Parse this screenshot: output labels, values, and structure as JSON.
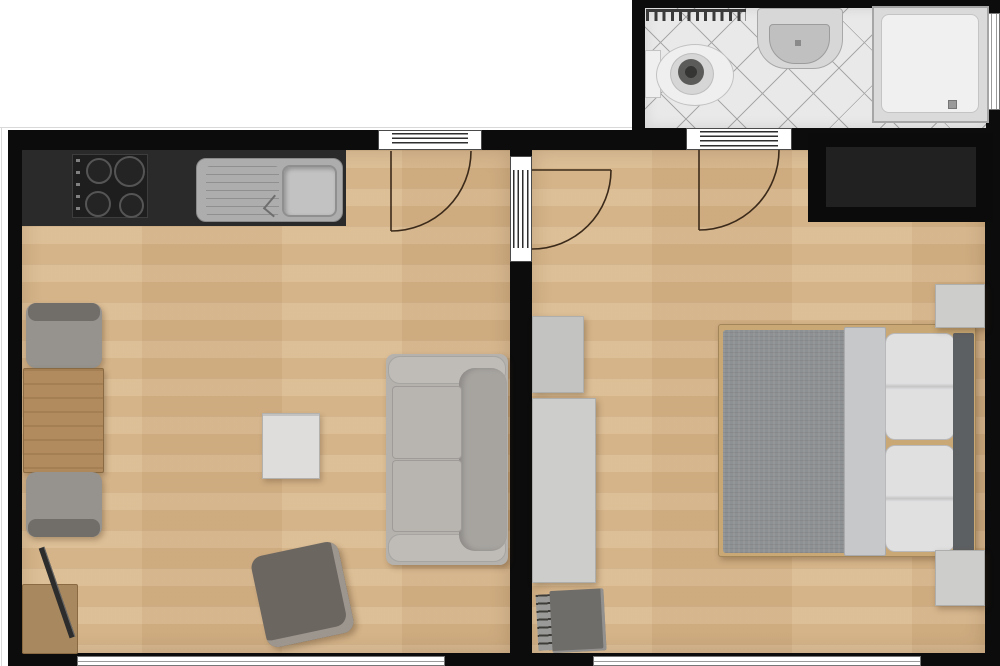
{
  "page": {
    "type": "apartment-floor-plan",
    "no_visible_text": true
  },
  "colors": {
    "bg": "#ffffff",
    "wall": "#0c0c0c",
    "floor-wood": "#d9b88c",
    "tile": "#e9e9e9",
    "tile-line": "#a8a8a8",
    "counter": "#2a2a2a",
    "appliance": "#1e1e1e",
    "steel": "#adadad",
    "steel-dark": "#8f8f8f",
    "porcelain": "#efefef",
    "porcelain-border": "#c2c2c2",
    "sofa": "#b5b2ae",
    "sofa-arm": "#bfbcb8",
    "sofa-back": "#a7a4a0",
    "cushion": "#b8b5b1",
    "chair": "#96928d",
    "chair-back": "#716e6a",
    "table-wood": "#b18b5d",
    "tv-stand-wood": "#a8885e",
    "armchair": "#6c6661",
    "armchair-rim": "#9d968f",
    "coffee-table": "#dedddb",
    "blanket": "#8e9193",
    "fold": "#c6c8ca",
    "pillow": "#e0e0e1",
    "pillow-border": "#b9b9bb",
    "headboard": "#5d6063",
    "bed-frame": "#c9a875",
    "cabinet": "#cdcdcb",
    "cabinet-border": "#aeaeac",
    "wardrobe-black": "#0b0b0b",
    "wardrobe-inner": "#212121",
    "radiator": "#6f6d6a",
    "radiator-slat": "#3f3d3a",
    "arc": "#3b2a1a",
    "window-line": "#9a9a9a",
    "edge-line": "#d9d9d9"
  },
  "rooms": [
    {
      "name": "living-room-with-kitchen",
      "floor": "wood"
    },
    {
      "name": "bedroom",
      "floor": "wood"
    },
    {
      "name": "bathroom",
      "floor": "diagonal-tile"
    }
  ],
  "furniture": {
    "living_room": [
      "kitchen-counter",
      "four-burner-stove",
      "kitchen-sink-with-drainboard",
      "dining-table",
      "dining-chair",
      "dining-chair",
      "tv-stand",
      "tv",
      "coffee-table",
      "armchair",
      "two-seat-sofa"
    ],
    "bedroom": [
      "double-bed",
      "pillow",
      "pillow",
      "headboard",
      "nightstand",
      "nightstand",
      "built-in-black-wardrobe",
      "white-wardrobe",
      "dresser",
      "radiator"
    ],
    "bathroom": [
      "towel-radiator",
      "toilet",
      "washbasin",
      "shower",
      "window"
    ]
  },
  "openings": {
    "doors": 3,
    "windows": 3
  }
}
